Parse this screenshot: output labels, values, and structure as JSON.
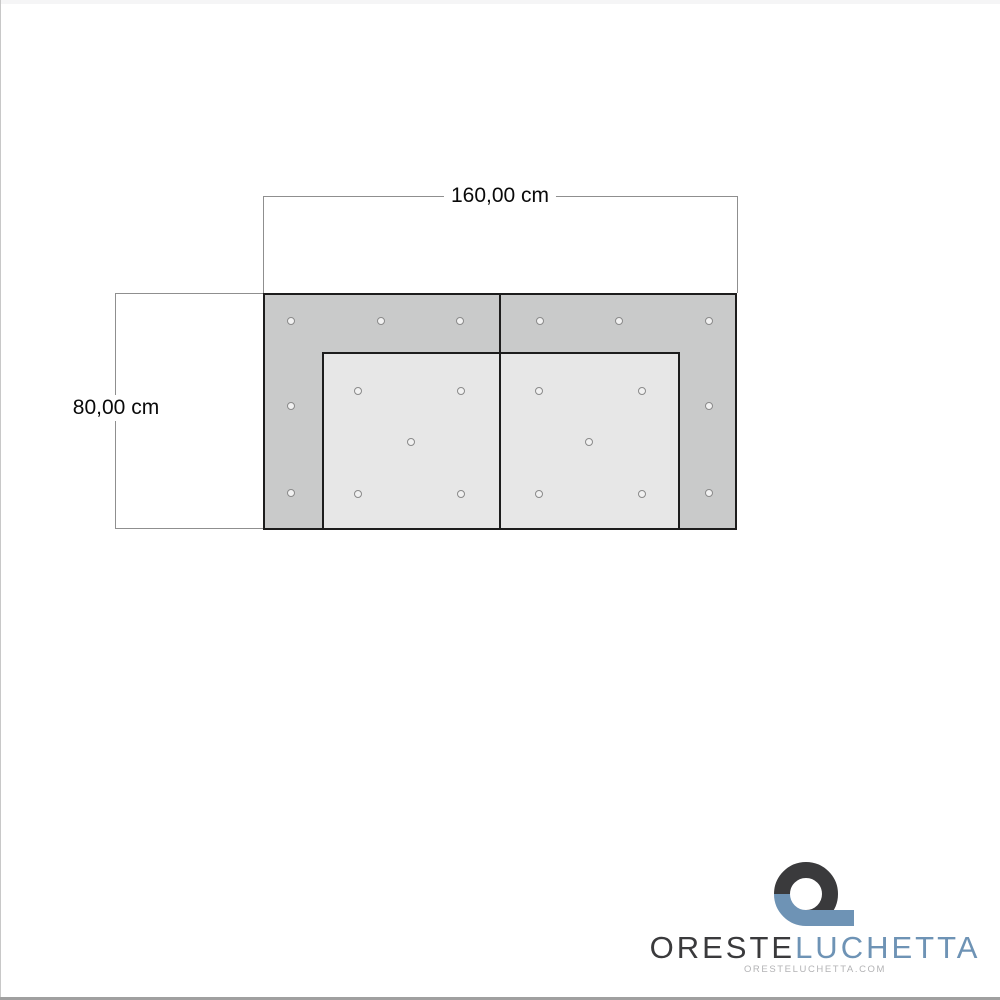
{
  "page": {
    "background": "#ffffff",
    "left_edge_color": "#c8c8c8",
    "bottom_bar_color": "#a0a0a0"
  },
  "diagram": {
    "type": "sofa-top-view-technical-drawing",
    "width_label": "160,00 cm",
    "height_label": "80,00 cm",
    "width_cm": 160,
    "height_cm": 80,
    "colors": {
      "frame_fill": "#c9caca",
      "cushion_fill": "#e7e7e7",
      "outline": "#1d1d1d",
      "dimension_line": "#8f8f8f",
      "dimension_text": "#0a0a0a",
      "button_stroke": "#8a8a8a",
      "button_fill": "#f1f1f1"
    },
    "buttons": [
      [
        291,
        321
      ],
      [
        381,
        321
      ],
      [
        460,
        321
      ],
      [
        540,
        321
      ],
      [
        619,
        321
      ],
      [
        709,
        321
      ],
      [
        291,
        406
      ],
      [
        709,
        406
      ],
      [
        291,
        493
      ],
      [
        709,
        493
      ],
      [
        358,
        391
      ],
      [
        461,
        391
      ],
      [
        411,
        442
      ],
      [
        358,
        494
      ],
      [
        461,
        494
      ],
      [
        539,
        391
      ],
      [
        642,
        391
      ],
      [
        589,
        442
      ],
      [
        539,
        494
      ],
      [
        642,
        494
      ]
    ]
  },
  "logo": {
    "brand_primary": "ORESTE",
    "brand_secondary": "LUCHETTA",
    "website": "ORESTELUCHETTA.COM",
    "colors": {
      "dark": "#3a3a3c",
      "blue": "#6e93b5",
      "website_text": "#b3b3b5"
    }
  }
}
